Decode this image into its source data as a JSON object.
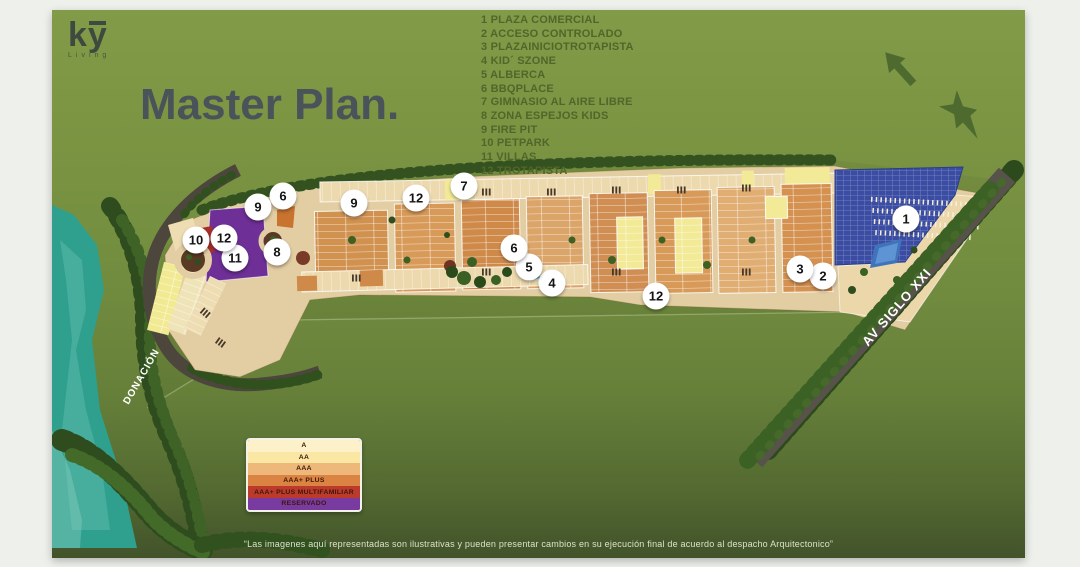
{
  "logo": {
    "brand": "ky",
    "sub": "Living"
  },
  "header": {
    "title": "Master Plan."
  },
  "amenities": {
    "items": [
      {
        "num": "1",
        "label": "PLAZA COMERCIAL"
      },
      {
        "num": "2",
        "label": "ACCESO CONTROLADO"
      },
      {
        "num": "3",
        "label": "PLAZAINICIOTROTAPISTA"
      },
      {
        "num": "4",
        "label": "KID´ SZONE"
      },
      {
        "num": "5",
        "label": "ALBERCA"
      },
      {
        "num": "6",
        "label": "BBQPLACE"
      },
      {
        "num": "7",
        "label": "GIMNASIO AL AIRE LIBRE"
      },
      {
        "num": "8",
        "label": "ZONA ESPEJOS KIDS"
      },
      {
        "num": "9",
        "label": "FIRE PIT"
      },
      {
        "num": "10",
        "label": "PETPARK"
      },
      {
        "num": "11",
        "label": "VILLAS"
      },
      {
        "num": "12",
        "label": "TROTAPISTA"
      }
    ]
  },
  "map": {
    "donacion_label": "DONACIÓN",
    "avenue_label": "AV SIGLO XXI",
    "markers": [
      {
        "n": "1",
        "x": 854,
        "y": 209
      },
      {
        "n": "2",
        "x": 771,
        "y": 266
      },
      {
        "n": "3",
        "x": 748,
        "y": 259
      },
      {
        "n": "4",
        "x": 500,
        "y": 273
      },
      {
        "n": "5",
        "x": 477,
        "y": 257
      },
      {
        "n": "6",
        "x": 462,
        "y": 238
      },
      {
        "n": "6",
        "x": 231,
        "y": 186
      },
      {
        "n": "7",
        "x": 412,
        "y": 176
      },
      {
        "n": "8",
        "x": 225,
        "y": 242
      },
      {
        "n": "9",
        "x": 206,
        "y": 197
      },
      {
        "n": "9",
        "x": 302,
        "y": 193
      },
      {
        "n": "10",
        "x": 144,
        "y": 230
      },
      {
        "n": "11",
        "x": 183,
        "y": 248
      },
      {
        "n": "12",
        "x": 172,
        "y": 228
      },
      {
        "n": "12",
        "x": 364,
        "y": 188
      },
      {
        "n": "12",
        "x": 604,
        "y": 286
      }
    ]
  },
  "legend_box": {
    "rows": [
      {
        "label": "A",
        "color": "#fcf1c8"
      },
      {
        "label": "AA",
        "color": "#fbe7a4"
      },
      {
        "label": "AAA",
        "color": "#edb879"
      },
      {
        "label": "AAA+ PLUS",
        "color": "#da8342"
      },
      {
        "label": "AAA+ PLUS MULTIFAMILIAR",
        "color": "#bc3a2b"
      },
      {
        "label": "RESERVADO",
        "color": "#7a3ba0"
      }
    ]
  },
  "disclaimer": {
    "text": "“Las imagenes aquí representadas son ilustrativas y pueden presentar cambios en su ejecución final de acuerdo al despacho Arquitectonico”"
  }
}
